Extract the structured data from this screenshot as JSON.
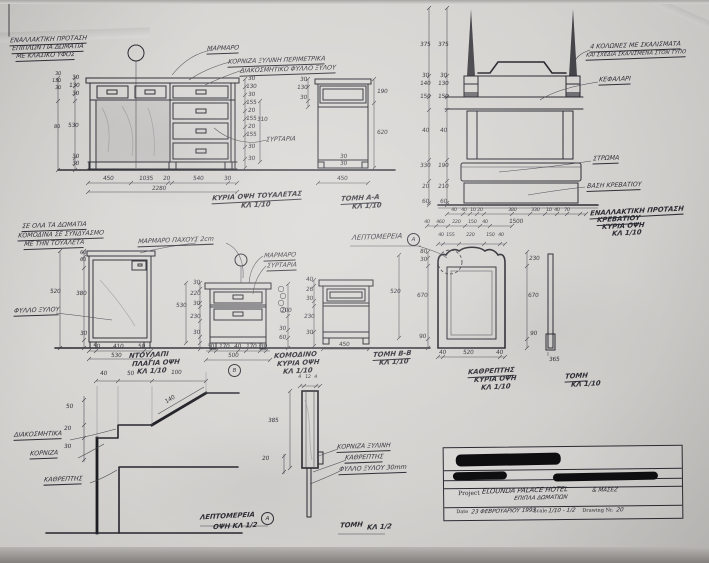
{
  "notes": {
    "alt_title": [
      "ΕΝΑΛΛΑΚΤΙΚΗ ΠΡΟΤΑΣΗ",
      "ΕΠΙΠΛΩΝ ΓΙΑ ΔΩΜΑΤΙΑ",
      "ΜΕ ΚΛΑΣΙΚΟ ΥΦΟΣ"
    ],
    "rooms_note": [
      "ΣΕ ΟΛΑ ΤΑ ΔΩΜΑΤΙΑ",
      "ΚΟΜΟΔΙΝΑ ΣΕ ΣΥΝΔΥΑΣΜΟ",
      "ΜΕ ΤΗΝ ΤΟΥΑΛΕΤΑ"
    ],
    "marble_note": "ΜΑΡΜΑΡΟ ΠΑΧΟΥΣ 2cm"
  },
  "desk": {
    "label_marble": "ΜΑΡΜΑΡΟ",
    "label_cornice": "ΚΟΡΝΙΖΑ ΞΥΛΙΝΗ ΠΕΡΙΜΕΤΡΙΚΑ",
    "label_veneer": "ΔΙΑΚΟΣΜΗΤΙΚΟ ΦΥΛΛΟ ΞΥΛΟΥ",
    "label_drawers": "ΣΥΡΤΑΡΙΑ",
    "dims_left_outer": [
      "30",
      "130",
      "30",
      "80"
    ],
    "dims_left": [
      "30",
      "130",
      "30",
      "530",
      "30",
      "30"
    ],
    "dims_right": [
      "30",
      "130",
      "30",
      "155",
      "20",
      "155",
      "20",
      "155",
      "30",
      "30"
    ],
    "dim_right_total": "310",
    "dims_bottom": [
      "450",
      "1035",
      "20",
      "540",
      "30"
    ],
    "dim_total": "2280",
    "caption": "ΚΥΡΙΑ ΟΨΗ ΤΟΥΑΛΕΤΑΣ",
    "caption_scale": "ΚΛ 1/10"
  },
  "section_aa": {
    "dims_left": [
      "30",
      "130",
      "30"
    ],
    "dims_right": [
      "190",
      "620"
    ],
    "dims_small": [
      "30",
      "30"
    ],
    "dim_width": "450",
    "caption": "ΤΟΜΗ Α-Α",
    "caption_scale": "ΚΛ 1/10"
  },
  "bed": {
    "label_posts_1": "4 ΚΟΛΩΝΕΣ ΜΕ ΣΚΑΛΙΣΜΑΤΑ",
    "label_posts_2": "ΚΑΙ ΣΧΕΔΙΑ ΣΚΑΛΙΣΜΕΝΑ ΣΤΟΝ ΤΥΠΟ",
    "label_headboard": "ΚΕΦΑΛΑΡΙ",
    "label_mattress": "ΣΤΡΩΜΑ",
    "label_base": "ΒΑΣΗ ΚΡΕΒΑΤΙΟΥ",
    "dims_left_outer": [
      "375",
      "30",
      "140",
      "150",
      "40",
      "330",
      "20",
      "60"
    ],
    "dims_left_inner": [
      "375",
      "30",
      "130",
      "150",
      "40",
      "190",
      "210",
      "60"
    ],
    "dims_bottom_1": [
      "40",
      "40",
      "10",
      "20",
      "380",
      "330",
      "10",
      "40",
      "70"
    ],
    "dims_bottom_2": [
      "40",
      "460",
      "220",
      "150",
      "40"
    ],
    "dim_total": "1500",
    "caption": [
      "ΕΝΑΛΛΑΚΤΙΚΗ ΠΡΟΤΑΣΗ",
      "ΚΡΕΒΑΤΙΟΥ",
      "ΚΥΡΙΑ ΟΨΗ",
      "ΚΛ 1/10"
    ]
  },
  "wardrobe": {
    "label_veneer": "ΦΥΛΛΟ ΞΥΛΟΥ",
    "dims_left": [
      "60",
      "60",
      "380",
      "30"
    ],
    "dim_left_outer": "520",
    "dims_bottom": [
      "50",
      "410",
      "50"
    ],
    "dim_total": "530",
    "caption": [
      "ΝΤΟΥΛΑΠΙ",
      "ΠΛΑΓΙΑ ΟΨΗ",
      "ΚΛ 1/10"
    ]
  },
  "nightstand": {
    "label_marble": "ΜΑΡΜΑΡΟ",
    "label_drawers": "ΣΥΡΤΑΡΙΑ",
    "dims_left": [
      "30",
      "220",
      "30",
      "230",
      "30"
    ],
    "dim_left_outer": "530",
    "dims_bottom": [
      "30",
      "170",
      "40",
      "170",
      "30"
    ],
    "dim_total": "500",
    "detail_mark": "Β",
    "caption": [
      "ΚΟΜΟΔΙΝΟ",
      "ΚΥΡΙΑ ΟΨΗ",
      "ΚΛ 1/10"
    ]
  },
  "coil_dims": [
    "200",
    "30",
    "60"
  ],
  "section_bb": {
    "dims_left": [
      "40",
      "26",
      "30",
      "230",
      "30"
    ],
    "dim_height": "520",
    "dim_width": "450",
    "caption": [
      "ΤΟΜΗ Β-Β",
      "ΚΛ 1/10"
    ]
  },
  "detail_header": {
    "label": "ΛΕΠΤΟΜΕΡΕΙΑ",
    "mark": "Α"
  },
  "mirror": {
    "dims_top": [
      "40",
      "155",
      "220",
      "150",
      "40"
    ],
    "dims_left": [
      "80",
      "30",
      "670",
      "90"
    ],
    "dims_right": [
      "230",
      "670",
      "90"
    ],
    "dims_bottom": [
      "40",
      "520",
      "40"
    ],
    "caption": [
      "ΚΑΘΡΕΠΤΗΣ",
      "ΚΥΡΙΑ ΟΨΗ",
      "ΚΛ 1/10"
    ]
  },
  "mirror_side": {
    "dim": "365",
    "caption": [
      "ΤΟΜΗ",
      "ΚΛ 1/10"
    ]
  },
  "detail_a": {
    "dims_top": [
      "40",
      "50",
      "100"
    ],
    "dim_slope": "140",
    "dims_left": [
      "50",
      "20",
      "30"
    ],
    "label_trim": "ΔΙΑΚΟΣΜΗΤΙΚΑ",
    "label_cornice": "ΚΟΡΝΙΖΑ",
    "label_mirror": "ΚΑΘΡΕΠΤΗΣ",
    "caption": "ΛΕΠΤΟΜΕΡΕΙΑ",
    "caption_mark": "Α",
    "caption_scale": "ΟΨΗ ΚΛ 1/2"
  },
  "mirror_detail": {
    "dims_top": [
      "4",
      "12",
      "4"
    ],
    "dims_left": [
      "385",
      "20"
    ],
    "label_1": "ΚΟΡΝΙΖΑ ΞΥΛΙΝΗ",
    "label_2": "ΚΑΘΡΕΠΤΗΣ",
    "label_3": "ΦΥΛΛΟ ΞΥΛΟΥ 30mm",
    "caption": "ΤΟΜΗ",
    "caption_scale": "ΚΛ 1/2"
  },
  "title_block": {
    "project_label": "Project",
    "project_value": "ELOUNDA PALACE HOTEL",
    "project_value_2": "ΕΠΙΠΛΑ ΔΩΜΑΤΙΩΝ",
    "project_value_3": "& ΜΑΣΕΖ",
    "date_label": "Date",
    "date_value": "23 ΦΕΒΡΟΥΑΡΙΟΥ 1993",
    "scale_label": "Scale",
    "scale_value": "1/10 - 1/2",
    "drawing_label": "Drawing Nr.",
    "drawing_value": "20"
  }
}
